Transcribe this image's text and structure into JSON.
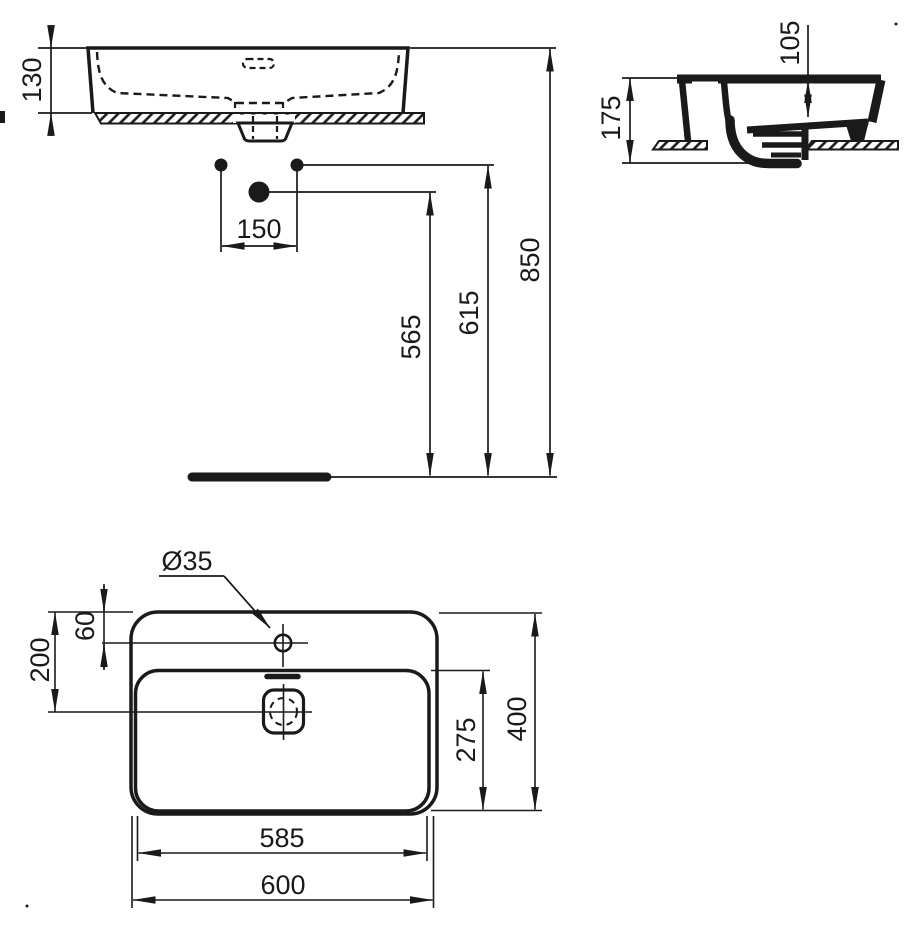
{
  "drawing": {
    "type": "washbasin-technical-drawing",
    "colors": {
      "line": "#1a1a1a",
      "background": "#ffffff"
    },
    "views": {
      "front": {
        "basin_height": "130",
        "tap_spacing": "150",
        "drain_outlet_height": "565",
        "tap_line_height": "615",
        "rim_height": "850"
      },
      "side": {
        "overall_depth": "175",
        "bowl_depth": "105"
      },
      "plan": {
        "tap_hole_diameter": "Ø35",
        "tap_hole_offset": "60",
        "drain_center_offset": "200",
        "bowl_depth_front": "275",
        "overall_depth": "400",
        "bowl_width": "585",
        "overall_width": "600"
      }
    }
  }
}
